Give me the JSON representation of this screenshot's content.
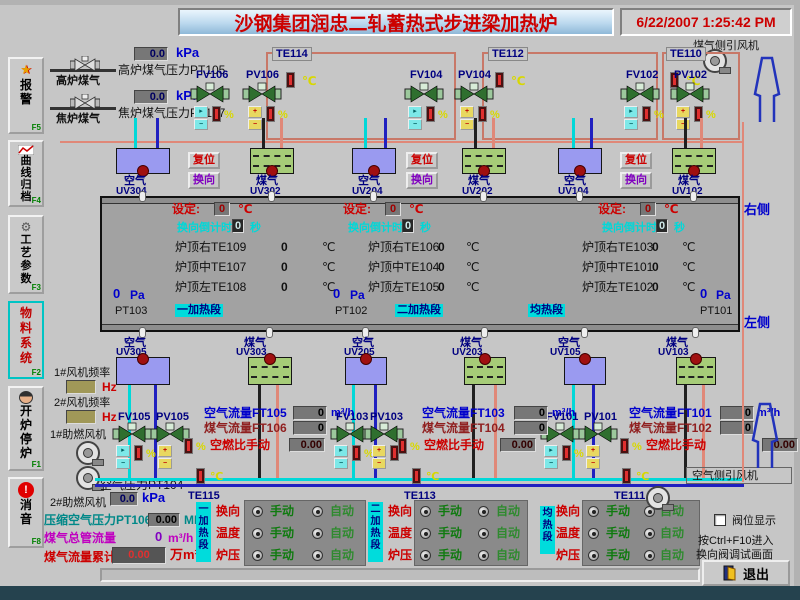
{
  "header": {
    "title": "沙钢集团润忠二轧蓄热式步进梁加热炉",
    "datetime": "6/22/2007 1:25:42 PM"
  },
  "sidebar": {
    "items": [
      {
        "label": "报警",
        "key": "F5"
      },
      {
        "label": "曲线归档",
        "key": "F4"
      },
      {
        "label": "工艺参数",
        "key": "F3"
      },
      {
        "label": "物料系统",
        "key": "F2"
      },
      {
        "label": "开炉停炉",
        "key": "F1"
      },
      {
        "label": "消音",
        "key": "F8"
      }
    ]
  },
  "common": {
    "air": "空气",
    "gas": "煤气",
    "deg": "℃",
    "pct": "%",
    "pa": "Pa",
    "sec": "秒",
    "reset": "复位",
    "reverse": "换向",
    "manual": "手动",
    "auto": "自动",
    "hz": "Hz",
    "temp": "温度",
    "press": "炉压",
    "flow_unit": "m³/h"
  },
  "supply": {
    "bf_pipe": "高炉煤气",
    "bf_value": "0.0",
    "bf_unit": "kPa",
    "bf_label": "高炉煤气压力PT105",
    "co_pipe": "焦炉煤气",
    "co_value": "0.0",
    "co_unit": "kPa",
    "co_label": "焦炉煤气压力PT107"
  },
  "fans": {
    "gas_side": "煤气侧引风机",
    "air_side": "空气侧引风机",
    "f1_label": "1#风机频率",
    "f1_value": "",
    "f2_label": "2#风机频率",
    "f2_value": "",
    "fan1": "1#助燃风机",
    "fan2": "2#助燃风机"
  },
  "top_zones": [
    {
      "te": "TE114",
      "fv": "FV106",
      "pv": "PV106",
      "air_uv": "UV304",
      "gas_uv": "UV302"
    },
    {
      "te": "TE112",
      "fv": "FV104",
      "pv": "PV104",
      "air_uv": "UV204",
      "gas_uv": "UV202"
    },
    {
      "te": "TE110",
      "fv": "FV102",
      "pv": "PV102",
      "air_uv": "UV104",
      "gas_uv": "UV102"
    }
  ],
  "panel": {
    "columns": [
      {
        "set_label": "设定:",
        "set_value": "0",
        "cd_label": "换向倒计时",
        "cd_value": "0",
        "temps": [
          {
            "label": "炉顶右TE109",
            "value": "0"
          },
          {
            "label": "炉顶中TE107",
            "value": "0"
          },
          {
            "label": "炉顶左TE108",
            "value": "0"
          }
        ],
        "pa_value": "0",
        "pt": "PT103",
        "section": "一加热段"
      },
      {
        "set_label": "设定:",
        "set_value": "0",
        "cd_label": "换向倒计时",
        "cd_value": "0",
        "temps": [
          {
            "label": "炉顶右TE106",
            "value": "0"
          },
          {
            "label": "炉顶中TE104",
            "value": "0"
          },
          {
            "label": "炉顶左TE105",
            "value": "0"
          }
        ],
        "pa_value": "0",
        "pt": "PT102",
        "section": "二加热段"
      },
      {
        "set_label": "设定:",
        "set_value": "0",
        "cd_label": "换向倒计时",
        "cd_value": "0",
        "temps": [
          {
            "label": "炉顶右TE103",
            "value": "0"
          },
          {
            "label": "炉顶中TE101",
            "value": "0"
          },
          {
            "label": "炉顶左TE102",
            "value": "0"
          }
        ],
        "pa_value": "0",
        "pt": "PT101",
        "section": "均热段"
      }
    ]
  },
  "bottom_zones": [
    {
      "air_uv": "UV305",
      "gas_uv": "UV303",
      "fv": "FV105",
      "pv": "PV105",
      "air_flow_label": "空气流量FT105",
      "air_flow_value": "0",
      "gas_flow_label": "煤气流量FT106",
      "gas_flow_value": "0",
      "ratio_label": "空燃比手动",
      "ratio_value": "0.00",
      "te": "TE115"
    },
    {
      "air_uv": "UV205",
      "gas_uv": "UV203",
      "fv": "FV103",
      "pv": "PV103",
      "air_flow_label": "空气流量FT103",
      "air_flow_value": "0",
      "gas_flow_label": "煤气流量FT104",
      "gas_flow_value": "0",
      "ratio_label": "空燃比手动",
      "ratio_value": "0.00",
      "te": "TE113"
    },
    {
      "air_uv": "UV105",
      "gas_uv": "UV103",
      "fv": "FV101",
      "pv": "PV101",
      "air_flow_label": "空气流量FT101",
      "air_flow_value": "0",
      "gas_flow_label": "煤气流量FT102",
      "gas_flow_value": "0",
      "ratio_label": "空燃比手动",
      "ratio_value": "0.00",
      "te": "TE111"
    }
  ],
  "left_readings": {
    "air_pressure_label": "空气压力PT104",
    "air_pressure_value": "0.0",
    "air_pressure_unit": "kPa",
    "comp_air_label": "压缩空气压力PT106",
    "comp_air_value": "0.00",
    "comp_air_unit": "MPa",
    "gas_main_label": "煤气总管流量",
    "gas_main_value": "0",
    "gas_main_unit": "m³/h",
    "gas_total_label": "煤气流量累计",
    "gas_total_value": "0.00",
    "gas_total_unit": "万m³"
  },
  "control_panels": [
    {
      "section": "一加热段"
    },
    {
      "section": "二加热段"
    },
    {
      "section": "均热段"
    }
  ],
  "side_labels": {
    "right": "右侧",
    "left": "左侧"
  },
  "footer": {
    "valve_pos": "阀位显示",
    "hint1": "按Ctrl+F10进入",
    "hint2": "换向阀调试画面",
    "exit": "退出"
  }
}
